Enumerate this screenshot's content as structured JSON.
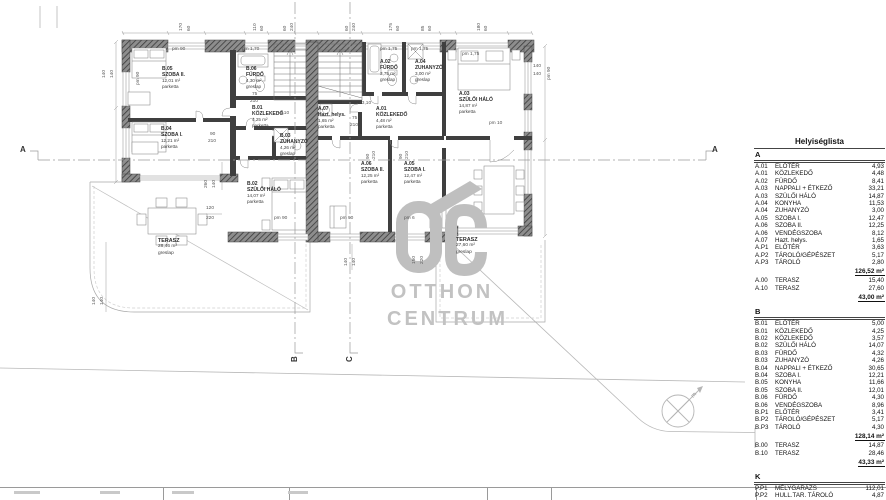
{
  "colors": {
    "wall": "#3f3f3f",
    "watermark": "#bfbfbf",
    "line": "#9a9a9a"
  },
  "watermark": {
    "line1": "OTTHON",
    "line2": "CENTRUM"
  },
  "table": {
    "title": "Helyiséglista",
    "sections": [
      {
        "key": "A",
        "rows": [
          [
            "A.01",
            "ELŐTÉR",
            "4,93"
          ],
          [
            "A.01",
            "KÖZLEKEDŐ",
            "4,48"
          ],
          [
            "A.02",
            "FÜRDŐ",
            "8,41"
          ],
          [
            "A.03",
            "NAPPALI + ÉTKEZŐ",
            "33,21"
          ],
          [
            "A.03",
            "SZÜLŐI HÁLÓ",
            "14,87"
          ],
          [
            "A.04",
            "KONYHA",
            "11,53"
          ],
          [
            "A.04",
            "ZUHANYZÓ",
            "3,00"
          ],
          [
            "A.05",
            "SZOBA I.",
            "12,47"
          ],
          [
            "A.06",
            "SZOBA II.",
            "12,25"
          ],
          [
            "A.06",
            "VENDÉGSZOBA",
            "8,12"
          ],
          [
            "A.07",
            "Hazt. helys.",
            "1,65"
          ],
          [
            "A.P1",
            "ELŐTÉR",
            "3,63"
          ],
          [
            "A.P2",
            "TÁROLÓ/GÉPÉSZET",
            "5,17"
          ],
          [
            "A.P3",
            "TÁROLÓ",
            "2,80"
          ]
        ],
        "subtotal": "126,52 m²",
        "extra": [
          [
            "A.00",
            "TERASZ",
            "15,40"
          ],
          [
            "A.10",
            "TERASZ",
            "27,60"
          ]
        ],
        "extra_total": "43,00 m²"
      },
      {
        "key": "B",
        "rows": [
          [
            "B.01",
            "ELŐTÉR",
            "5,00"
          ],
          [
            "B.01",
            "KÖZLEKEDŐ",
            "4,25"
          ],
          [
            "B.02",
            "KÖZLEKEDŐ",
            "3,57"
          ],
          [
            "B.02",
            "SZÜLŐI HÁLÓ",
            "14,07"
          ],
          [
            "B.03",
            "FÜRDŐ",
            "4,32"
          ],
          [
            "B.03",
            "ZUHANYZÓ",
            "4,26"
          ],
          [
            "B.04",
            "NAPPALI + ÉTKEZŐ",
            "30,65"
          ],
          [
            "B.04",
            "SZOBA I.",
            "12,21"
          ],
          [
            "B.05",
            "KONYHA",
            "11,66"
          ],
          [
            "B.05",
            "SZOBA II.",
            "12,01"
          ],
          [
            "B.06",
            "FÜRDŐ",
            "4,30"
          ],
          [
            "B.06",
            "VENDÉGSZOBA",
            "8,96"
          ],
          [
            "B.P1",
            "ELŐTÉR",
            "3,41"
          ],
          [
            "B.P2",
            "TÁROLÓ/GÉPÉSZET",
            "5,17"
          ],
          [
            "B.P3",
            "TÁROLÓ",
            "4,30"
          ]
        ],
        "subtotal": "128,14 m²",
        "extra": [
          [
            "B.00",
            "TERASZ",
            "14,87"
          ],
          [
            "B.10",
            "TERASZ",
            "28,46"
          ]
        ],
        "extra_total": "43,33 m²"
      },
      {
        "key": "K",
        "rows": [
          [
            "P.P1",
            "MÉLYGARÁZS",
            "112,01"
          ],
          [
            "P.P2",
            "HULL.TAR. TÁROLÓ",
            "4,87"
          ]
        ],
        "subtotal": "116,88 m²",
        "extra": [],
        "extra_total": null,
        "grand_total": "457,87 m²"
      }
    ]
  },
  "plan": {
    "room_labels": [
      {
        "code": "B.05",
        "name": "SZOBA II.",
        "area": "12,01 m²",
        "finish": "parketta",
        "x": 162,
        "y": 66
      },
      {
        "code": "B.06",
        "name": "FÜRDŐ",
        "area": "4,30 m²",
        "finish": "greslap",
        "x": 246,
        "y": 66
      },
      {
        "code": "B.01",
        "name": "KÖZLEKEDŐ",
        "area": "4,25 m²",
        "finish": "parketta",
        "x": 252,
        "y": 105
      },
      {
        "code": "B.04",
        "name": "SZOBA I.",
        "area": "12,21 m²",
        "finish": "parketta",
        "x": 161,
        "y": 126
      },
      {
        "code": "B.03",
        "name": "ZUHANYZÓ",
        "area": "4,26 m²",
        "finish": "greslap",
        "x": 280,
        "y": 133
      },
      {
        "code": "B.02",
        "name": "SZÜLŐI HÁLÓ",
        "area": "14,07 m²",
        "finish": "parketta",
        "x": 247,
        "y": 181
      },
      {
        "code": "A.02",
        "name": "FÜRDŐ",
        "area": "3,75 m²",
        "finish": "greslap",
        "x": 380,
        "y": 59
      },
      {
        "code": "A.04",
        "name": "ZUHANYZÓ",
        "area": "3,00 m²",
        "finish": "greslap",
        "x": 415,
        "y": 59
      },
      {
        "code": "A.03",
        "name": "SZÜLŐI HÁLÓ",
        "area": "14,87 m²",
        "finish": "parketta",
        "x": 459,
        "y": 91
      },
      {
        "code": "A.07",
        "name": "Hazt. helys.",
        "area": "1,65 m²",
        "finish": "parketta",
        "x": 318,
        "y": 106
      },
      {
        "code": "A.01",
        "name": "KÖZLEKEDŐ",
        "area": "4,48 m²",
        "finish": "parketta",
        "x": 376,
        "y": 106
      },
      {
        "code": "A.06",
        "name": "SZOBA II.",
        "area": "12,25 m²",
        "finish": "parketta",
        "x": 361,
        "y": 161
      },
      {
        "code": "A.05",
        "name": "SZOBA I.",
        "area": "12,47 m²",
        "finish": "parketta",
        "x": 404,
        "y": 161
      }
    ],
    "terrace_labels": [
      {
        "name": "TERASZ",
        "area": "28,46 m²",
        "finish": "greslap",
        "x": 158,
        "y": 238
      },
      {
        "name": "TERASZ",
        "area": "27,60 m²",
        "finish": "greslap",
        "x": 456,
        "y": 237
      }
    ],
    "annotations": [
      {
        "t": "pm 90",
        "x": 172,
        "y": 47
      },
      {
        "t": "pm 1,70",
        "x": 242,
        "y": 47
      },
      {
        "t": "pm 1,75",
        "x": 380,
        "y": 47
      },
      {
        "t": "pm 1,75",
        "x": 411,
        "y": 47
      },
      {
        "t": "pm 1,75",
        "x": 462,
        "y": 52
      },
      {
        "t": "pm 10",
        "x": 489,
        "y": 121
      },
      {
        "t": "+3,10",
        "x": 359,
        "y": 101
      },
      {
        "t": "+4,10",
        "x": 277,
        "y": 111
      },
      {
        "t": "140",
        "x": 533,
        "y": 64
      },
      {
        "t": "140",
        "x": 533,
        "y": 72
      },
      {
        "t": "pm 90",
        "x": 274,
        "y": 216
      },
      {
        "t": "pm 90",
        "x": 340,
        "y": 216
      },
      {
        "t": "pm 6",
        "x": 404,
        "y": 216
      },
      {
        "t": "75",
        "x": 252,
        "y": 92
      },
      {
        "t": "210",
        "x": 250,
        "y": 99
      },
      {
        "t": "75",
        "x": 352,
        "y": 116
      },
      {
        "t": "210",
        "x": 350,
        "y": 123
      },
      {
        "t": "90",
        "x": 210,
        "y": 132
      },
      {
        "t": "210",
        "x": 208,
        "y": 139
      },
      {
        "t": "120",
        "x": 206,
        "y": 206
      },
      {
        "t": "220",
        "x": 206,
        "y": 216
      }
    ],
    "dims": [
      {
        "t": "170",
        "x": 179,
        "y": 31
      },
      {
        "t": "60",
        "x": 187,
        "y": 31
      },
      {
        "t": "110",
        "x": 253,
        "y": 31
      },
      {
        "t": "60",
        "x": 260,
        "y": 31
      },
      {
        "t": "60",
        "x": 283,
        "y": 31
      },
      {
        "t": "240",
        "x": 290,
        "y": 31
      },
      {
        "t": "60",
        "x": 345,
        "y": 31
      },
      {
        "t": "240",
        "x": 352,
        "y": 31
      },
      {
        "t": "175",
        "x": 389,
        "y": 31
      },
      {
        "t": "60",
        "x": 396,
        "y": 31
      },
      {
        "t": "85",
        "x": 421,
        "y": 31
      },
      {
        "t": "60",
        "x": 428,
        "y": 31
      },
      {
        "t": "180",
        "x": 477,
        "y": 31
      },
      {
        "t": "60",
        "x": 484,
        "y": 31
      },
      {
        "t": "140",
        "x": 102,
        "y": 78
      },
      {
        "t": "140",
        "x": 110,
        "y": 78
      },
      {
        "t": "pm 90",
        "x": 136,
        "y": 85
      },
      {
        "t": "pm 90",
        "x": 547,
        "y": 80
      },
      {
        "t": "260",
        "x": 204,
        "y": 188
      },
      {
        "t": "140",
        "x": 212,
        "y": 188
      },
      {
        "t": "90",
        "x": 366,
        "y": 159
      },
      {
        "t": "210",
        "x": 372,
        "y": 159
      },
      {
        "t": "90",
        "x": 399,
        "y": 159
      },
      {
        "t": "210",
        "x": 405,
        "y": 159
      },
      {
        "t": "140",
        "x": 344,
        "y": 266
      },
      {
        "t": "140",
        "x": 352,
        "y": 266
      },
      {
        "t": "150",
        "x": 412,
        "y": 264
      },
      {
        "t": "220",
        "x": 420,
        "y": 264
      },
      {
        "t": "140",
        "x": 92,
        "y": 305
      },
      {
        "t": "140",
        "x": 100,
        "y": 305
      }
    ],
    "section_markers": [
      {
        "t": "A",
        "x": 20,
        "y": 145,
        "rot": false
      },
      {
        "t": "A",
        "x": 712,
        "y": 145,
        "rot": false
      },
      {
        "t": "B",
        "x": 290,
        "y": 362,
        "rot": true
      },
      {
        "t": "C",
        "x": 345,
        "y": 362,
        "rot": true
      }
    ],
    "north_label": "É"
  },
  "titleblock": {
    "dividers": [
      163,
      289,
      487,
      551,
      756
    ],
    "smudges": [
      [
        14,
        26
      ],
      [
        100,
        20
      ],
      [
        172,
        22
      ],
      [
        288,
        20
      ]
    ]
  }
}
